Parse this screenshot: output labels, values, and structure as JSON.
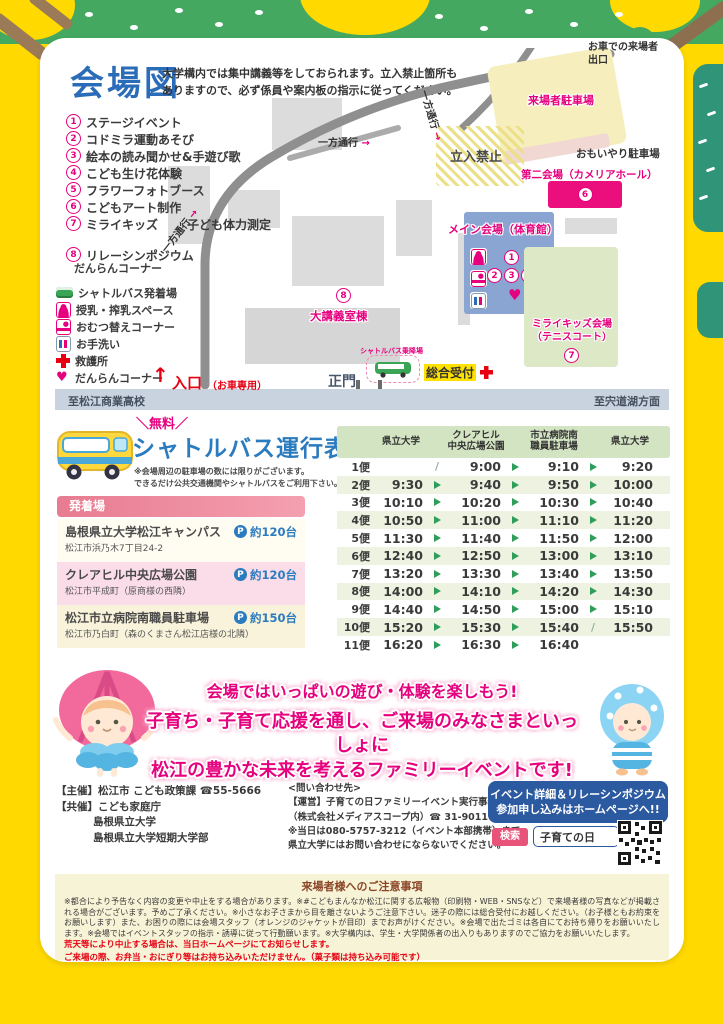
{
  "colors": {
    "accent_pink": "#e6007e",
    "title_blue": "#2b6cb8",
    "table_green": "#2f9e5b",
    "alert_red": "#e60012",
    "box_blue": "#2c5aa0",
    "page_yellow": "#ffd900"
  },
  "map": {
    "title": "会場図",
    "notice1": "大学構内では集中講義等をしておられます。立入禁止箇所も",
    "notice2": "ありますので、必ず係員や案内板の指示に従ってください。",
    "activities": [
      {
        "n": "1",
        "t": "ステージイベント"
      },
      {
        "n": "2",
        "t": "コドミラ運動あそび"
      },
      {
        "n": "3",
        "t": "絵本の読み聞かせ&手遊び歌"
      },
      {
        "n": "4",
        "t": "こども生け花体験"
      },
      {
        "n": "5",
        "t": "フラワーフォトブース"
      },
      {
        "n": "6",
        "t": "こどもアート制作"
      },
      {
        "n": "7",
        "t": "ミライキッズ",
        "t2": "子ども体力測定"
      },
      {
        "n": "8",
        "t": "リレーシンポジウム"
      }
    ],
    "corner": "だんらんコーナー",
    "legend": [
      {
        "icon": "shuttle-bus-icon",
        "label": "シャトルバス発着場"
      },
      {
        "icon": "nursing-icon",
        "label": "授乳・搾乳スペース"
      },
      {
        "icon": "diaper-icon",
        "label": "おむつ替えコーナー"
      },
      {
        "icon": "restroom-icon",
        "label": "お手洗い"
      },
      {
        "icon": "first-aid-icon",
        "label": "救護所"
      },
      {
        "icon": "heart-icon",
        "label": "だんらんコーナー"
      }
    ],
    "labels": {
      "exit_l1": "お車での来場者",
      "exit_l2": "出口",
      "visitor_parking": "来場者駐車場",
      "oneway": "一方通行",
      "oneway_arrow": "→",
      "no_entry": "立入禁止",
      "care_parking": "おもいやり駐車場",
      "second_venue": "第二会場（カメリアホール）",
      "second_venue_num": "6",
      "main_venue": "メイン会場（体育館）",
      "num1": "1",
      "num2": "2",
      "num3": "3",
      "num4": "4",
      "num5": "5",
      "heart": "♥",
      "mirai_l1": "ミライキッズ会場",
      "mirai_l2": "（テニスコート）",
      "mirai_num": "7",
      "lecture_num": "8",
      "lecture_hall": "大講義室棟",
      "shuttle_stop": "シャトルバス乗降場",
      "reception": "総合受付",
      "main_gate": "正門",
      "main_gate_note": "（歩いての入場はこちらから）",
      "entrance": "入口",
      "entrance_note": "（お車専用）",
      "entrance_arrow": "↑",
      "to_school": "至松江商業高校",
      "to_lake": "至宍道湖方面"
    }
  },
  "shuttle": {
    "free_label": "＼無料／",
    "title": "シャトルバス運行表",
    "note1": "※会場周辺の駐車場の数には限りがございます。",
    "note2": "できるだけ公共交通機関やシャトルバスをご利用下さい。",
    "stops_header": "発着場",
    "stops": [
      {
        "name": "島根県立大学松江キャンパス",
        "capacity": "約120台",
        "address": "松江市浜乃木7丁目24-2"
      },
      {
        "name": "クレアヒル中央広場公園",
        "capacity": "約120台",
        "address": "松江市平成町（原商様の西隣）"
      },
      {
        "name": "松江市立病院南職員駐車場",
        "capacity": "約150台",
        "address": "松江市乃白町（森のくまさん松江店様の北隣）"
      }
    ],
    "timetable": {
      "columns": [
        [
          "県立大学",
          ""
        ],
        [
          "クレアヒル",
          "中央広場公園"
        ],
        [
          "市立病院南",
          "職員駐車場"
        ],
        [
          "県立大学",
          ""
        ]
      ],
      "rows": [
        {
          "label": "1便",
          "cells": [
            "",
            "9:00",
            "9:10",
            "9:20"
          ],
          "seps": [
            "slash",
            "arrow",
            "arrow"
          ]
        },
        {
          "label": "2便",
          "cells": [
            "9:30",
            "9:40",
            "9:50",
            "10:00"
          ],
          "seps": [
            "arrow",
            "arrow",
            "arrow"
          ]
        },
        {
          "label": "3便",
          "cells": [
            "10:10",
            "10:20",
            "10:30",
            "10:40"
          ],
          "seps": [
            "arrow",
            "arrow",
            "arrow"
          ]
        },
        {
          "label": "4便",
          "cells": [
            "10:50",
            "11:00",
            "11:10",
            "11:20"
          ],
          "seps": [
            "arrow",
            "arrow",
            "arrow"
          ]
        },
        {
          "label": "5便",
          "cells": [
            "11:30",
            "11:40",
            "11:50",
            "12:00"
          ],
          "seps": [
            "arrow",
            "arrow",
            "arrow"
          ]
        },
        {
          "label": "6便",
          "cells": [
            "12:40",
            "12:50",
            "13:00",
            "13:10"
          ],
          "seps": [
            "arrow",
            "arrow",
            "arrow"
          ]
        },
        {
          "label": "7便",
          "cells": [
            "13:20",
            "13:30",
            "13:40",
            "13:50"
          ],
          "seps": [
            "arrow",
            "arrow",
            "arrow"
          ]
        },
        {
          "label": "8便",
          "cells": [
            "14:00",
            "14:10",
            "14:20",
            "14:30"
          ],
          "seps": [
            "arrow",
            "arrow",
            "arrow"
          ]
        },
        {
          "label": "9便",
          "cells": [
            "14:40",
            "14:50",
            "15:00",
            "15:10"
          ],
          "seps": [
            "arrow",
            "arrow",
            "arrow"
          ]
        },
        {
          "label": "10便",
          "cells": [
            "15:20",
            "15:30",
            "15:40",
            "15:50"
          ],
          "seps": [
            "arrow",
            "arrow",
            "slash"
          ]
        },
        {
          "label": "11便",
          "cells": [
            "16:20",
            "16:30",
            "16:40",
            ""
          ],
          "seps": [
            "arrow",
            "arrow",
            "none"
          ]
        }
      ]
    }
  },
  "banner": {
    "line1": "会場ではいっぱいの遊び・体験を楽しもう!",
    "line2": "子育ち・子育て応援を通し、ご来場のみなさまといっしょに",
    "line3": "松江の豊かな未来を考えるファミリーイベントです!"
  },
  "footer": {
    "organizer": [
      "【主催】松江市 こども政策課 ☎55-5666",
      "【共催】こども家庭庁",
      "島根県立大学",
      "島根県立大学短期大学部"
    ],
    "contact": [
      "<問い合わせ先>",
      "【運営】子育ての日ファミリーイベント実行事務局",
      "（株式会社メディアスコープ内）☎ 31-9011",
      "※当日は080-5757-3212（イベント本部携帯）まで。",
      "県立大学にはお問い合わせにならないでください。"
    ],
    "web_box_l1": "イベント詳細＆リレーシンポジウム",
    "web_box_l2": "参加申し込みはホームページへ!!",
    "search_button": "検索",
    "search_value": "子育ての日"
  },
  "notes": {
    "header": "来場者様へのご注意事項",
    "body": "※都合により予告なく内容の変更や中止をする場合があります。※#こどもまんなか松江に関する広報物（印刷物・WEB・SNSなど）で来場者様の写真などが掲載される場合がございます。予めご了承ください。※小さなお子さまから目を離さないようご注意下さい。迷子の際には総合受付にお越しください。（お子様ともお約束をお願いします）また、お困りの際には会場スタッフ（オレンジのジャケットが目印）までお声がけください。※会場で出たゴミは各自にてお持ち帰りをお願いいたします。※会場ではイベントスタッフの指示・誘導に従って行動願います。※大学構内は、学生・大学関係者の出入りもありますのでご協力をお願いいたします。",
    "red1": "荒天等により中止する場合は、当日ホームページにてお知らせします。",
    "red2": "ご来場の際、お弁当・おにぎり等はお持ち込みいただけません。（菓子類は持ち込み可能です）"
  }
}
